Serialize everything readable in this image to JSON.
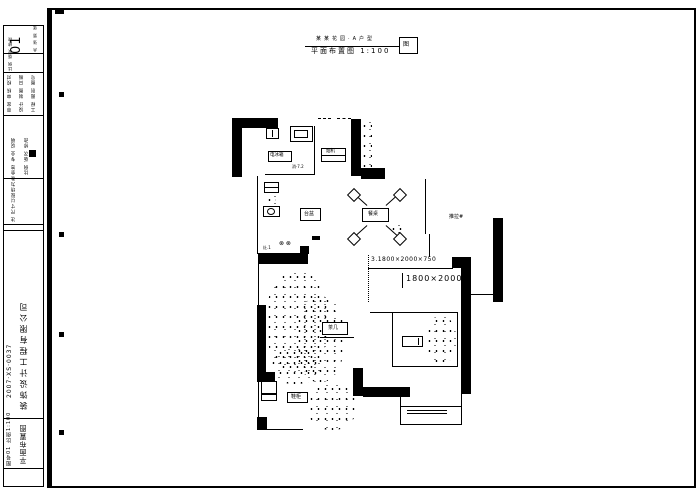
{
  "sheet": {
    "bg": "#ffffff",
    "ink": "#000000",
    "header": {
      "small_text": "某某花园·A户型",
      "title": "平面布置图 1:100",
      "box_mark": "图"
    },
    "title_block": {
      "sheet_no": "01",
      "note": "共 张 第 张",
      "rows_a": "审定 审核 校对",
      "rows_b": "设计 制图 日期",
      "rows_c": "工程 图别 图号",
      "rows_d": "比例 版次 修改",
      "rows_e": "会签 专业 说明",
      "rows_f": "注 尺寸以现场为准",
      "firm": "装饰设计工程有限公司",
      "firm_no": "2007·XS·0037",
      "drawing_name": "平面布置图",
      "drawing_meta": "图号01 比例1:100"
    },
    "plan": {
      "dim_line1": "3.1800×2000×750",
      "dim_line2": "1800×2000",
      "door_tag": "推拉#",
      "dining_label": "餐桌",
      "hood_label": "烟机",
      "fridge_label": "电冰箱",
      "kitchen_tag": "消·7.2",
      "sink_label": "台盆",
      "stove_burners": "⊗ ⊗",
      "stove_tag": "灶.1",
      "coffee_label": "茶几",
      "stand_label": "鞋柜"
    }
  }
}
